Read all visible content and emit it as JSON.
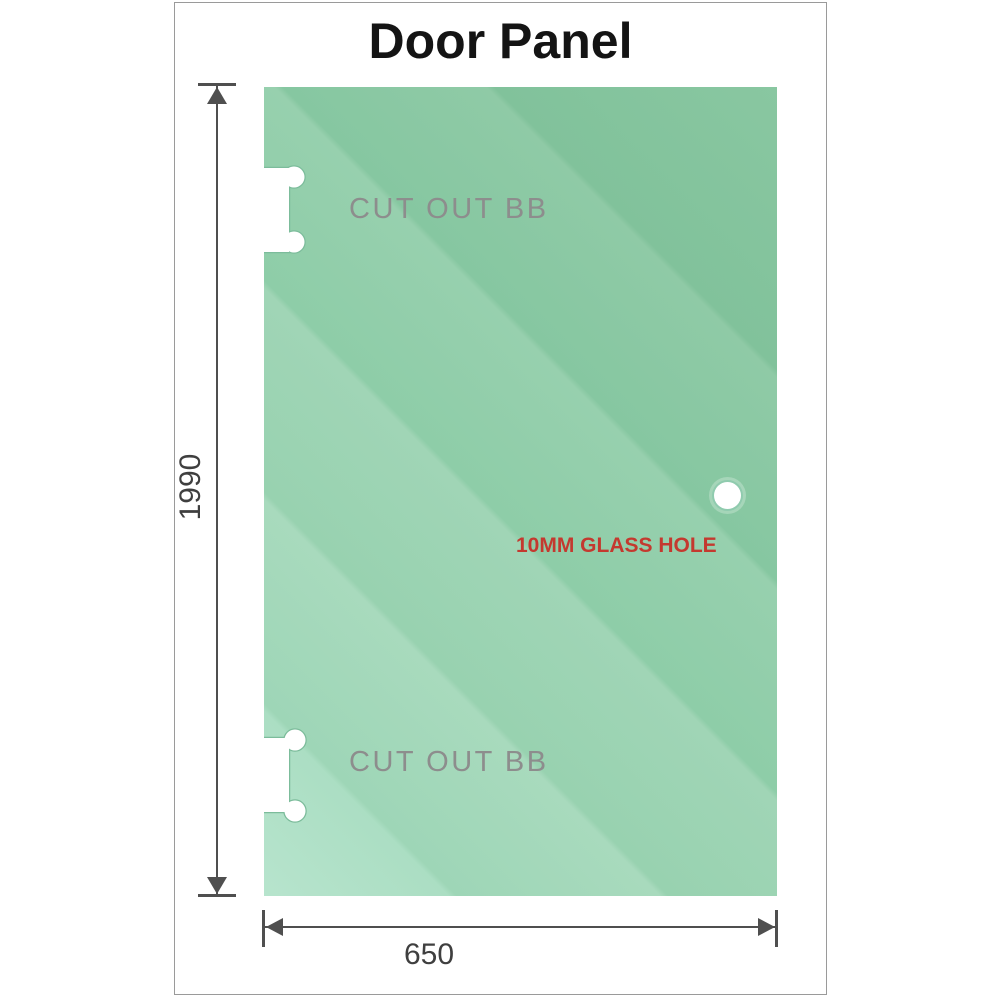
{
  "title": "Door Panel",
  "panel": {
    "cutout_top_label": "CUT OUT BB",
    "cutout_bottom_label": "CUT OUT BB",
    "hole_label": "10MM GLASS HOLE"
  },
  "dimensions": {
    "height_mm": "1990",
    "width_mm": "650"
  },
  "colors": {
    "glass_base": "#98d1b0",
    "glass_light": "#b7e4cd",
    "glass_dark": "#81c29b",
    "dimension_line": "#4f4f4f",
    "cutout_label_gray": "#8d8d8d",
    "hole_label_red": "#c4392f",
    "frame_border": "#9a9a9a",
    "title_text": "#141414"
  }
}
